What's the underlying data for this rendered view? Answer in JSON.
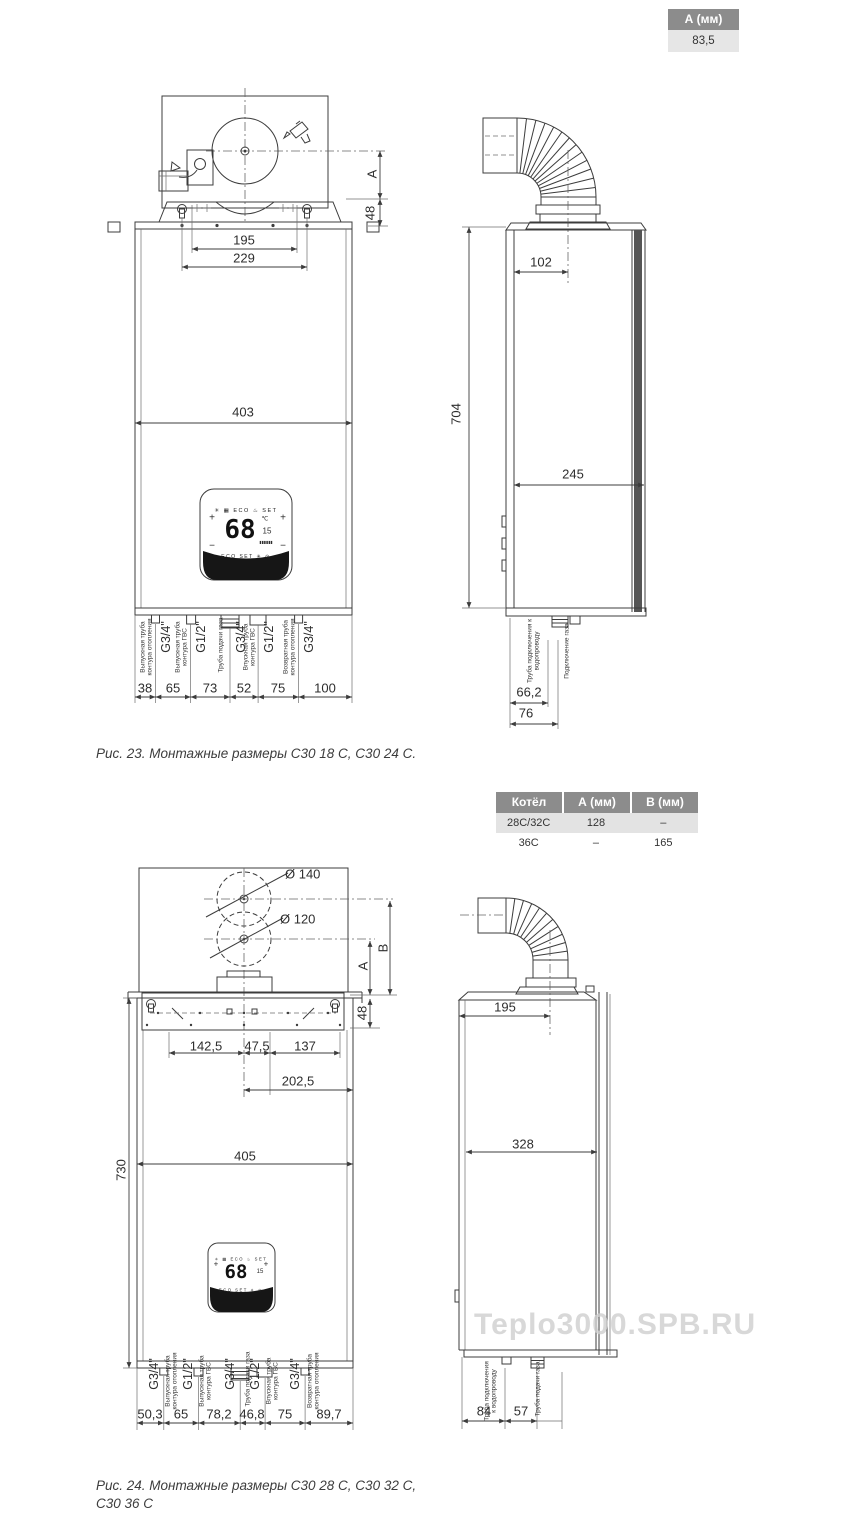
{
  "top_table": {
    "header": "А (мм)",
    "value": "83,5"
  },
  "boiler_table": {
    "headers": [
      "Котёл",
      "А (мм)",
      "В (мм)"
    ],
    "rows": [
      [
        "28C/32C",
        "128",
        "–"
      ],
      [
        "36C",
        "–",
        "165"
      ]
    ]
  },
  "fig23": {
    "caption": "Рис. 23. Монтажные размеры С30 18 С, С30 24 С.",
    "front": {
      "dim_a": "A",
      "dim_48": "48",
      "dim_195": "195",
      "dim_229": "229",
      "dim_403": "403",
      "pipes": [
        {
          "size": "G3/4\"",
          "desc": "Выпускная труба контура отопления"
        },
        {
          "size": "G1/2\"",
          "desc": "Выпускная труба контура ГВС"
        },
        {
          "size": "G3/4\"",
          "desc": "Труба подачи газа"
        },
        {
          "size": "G1/2\"",
          "desc": "Впускная труба контура ГВС"
        },
        {
          "size": "G3/4\"",
          "desc": "Возвратная труба контура отопления"
        }
      ],
      "dims": [
        "38",
        "65",
        "73",
        "52",
        "75",
        "100"
      ]
    },
    "side": {
      "dim_102": "102",
      "dim_704": "704",
      "dim_245": "245",
      "dim_66_2": "66,2",
      "dim_76": "76",
      "water_label": "Труба подключения к водопроводу",
      "gas_label": "Подключение газа"
    }
  },
  "fig24": {
    "caption_line1": "Рис. 24. Монтажные размеры С30 28 С, С30 32 С,",
    "caption_line2": "С30 36 С",
    "front": {
      "d140": "Ø 140",
      "d120": "Ø 120",
      "dim_b": "B",
      "dim_a": "A",
      "dim_48": "48",
      "dim_142_5": "142,5",
      "dim_47_5": "47,5",
      "dim_137": "137",
      "dim_202_5": "202,5",
      "dim_405": "405",
      "dim_730": "730",
      "pipes": [
        {
          "size": "G3/4\"",
          "desc": "Выпускная труба контура отопления"
        },
        {
          "size": "G1/2\"",
          "desc": "Выпускная труба контура ГВС"
        },
        {
          "size": "G3/4\"",
          "desc": "Труба подачи газа"
        },
        {
          "size": "G1/2\"",
          "desc": "Впускная труба контура ГВС"
        },
        {
          "size": "G3/4\"",
          "desc": "Возвратная труба контура отопления"
        }
      ],
      "dims": [
        "50,3",
        "65",
        "78,2",
        "46,8",
        "75",
        "89,7"
      ]
    },
    "side": {
      "dim_195": "195",
      "dim_328": "328",
      "dim_84": "84",
      "dim_57": "57",
      "water_label": "Труба подключения к водопроводу",
      "gas_label": "Труба подачи газа"
    }
  },
  "display": {
    "value": "68",
    "top_icons": "✳ ▦ ECO ♨ SET",
    "bottom_icons": "ECO SET ✳ ⊙",
    "temp_unit": "℃",
    "sub_value": "15",
    "bars": "▮▮▮▮▮▮",
    "plus": "+",
    "minus": "−"
  },
  "watermark": "Teplo3000.SPB.RU"
}
